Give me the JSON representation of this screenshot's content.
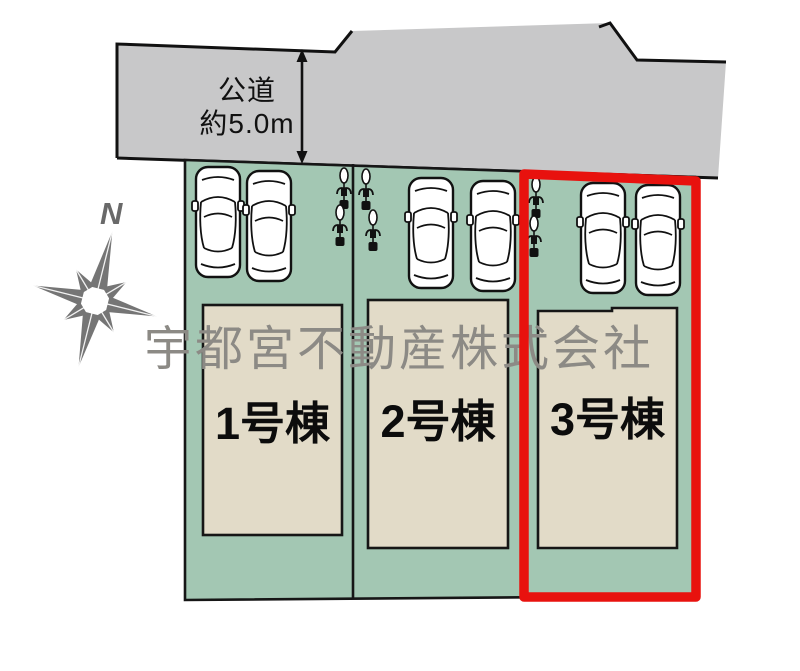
{
  "road": {
    "name_label": "公道",
    "width_label": "約5.0m"
  },
  "compass": {
    "north_label": "N"
  },
  "watermark": {
    "text": "宇都宮不動産株式会社"
  },
  "plots": [
    {
      "label": "1号棟",
      "cars": 2,
      "bicycles": 2,
      "highlighted": false
    },
    {
      "label": "2号棟",
      "cars": 2,
      "bicycles": 2,
      "highlighted": false
    },
    {
      "label": "3号棟",
      "cars": 2,
      "bicycles": 2,
      "highlighted": true
    }
  ],
  "icons": {
    "car": "car-top-view-icon",
    "bicycle": "bicycle-top-view-icon",
    "compass": "compass-rose-icon",
    "arrow": "road-width-arrow-icon"
  },
  "colors": {
    "road": "#c8c8c9",
    "plot": "#a3c7b3",
    "house": "#e2dbc8",
    "highlight": "#e8120e",
    "watermark": "#8c8a85",
    "compass": "#757575",
    "line": "#161616"
  }
}
